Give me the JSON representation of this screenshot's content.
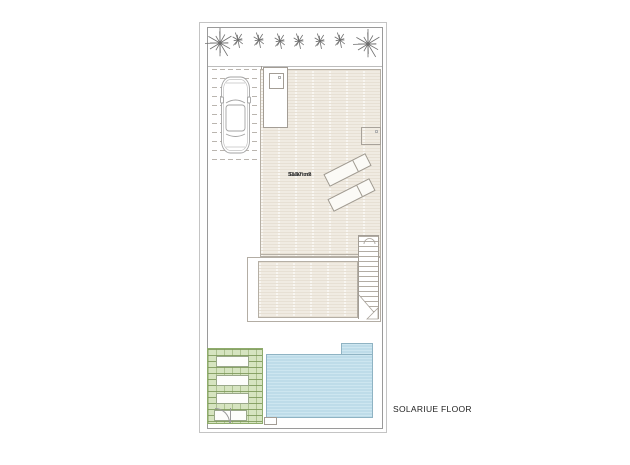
{
  "floor_label": "SOLARIUE FLOOR",
  "solarium": {
    "name": "Solarium",
    "area": "33.97 m2"
  },
  "colors": {
    "line": "#9a9a9a",
    "wall": "#a39d95",
    "deck-border": "#b5afa5",
    "deck-base": "#f0ebe2",
    "deck-stripe": "#e7e0d4",
    "pool-fill": "#bedce9",
    "pool-stripe": "#cde6f0",
    "pool-border": "#8fb3c3",
    "grass-fill": "#d6e4c0",
    "grass-line": "#8fac6c",
    "text": "#222222"
  },
  "trees": [
    {
      "kind": "palm-large",
      "x": 220,
      "y": 43
    },
    {
      "kind": "palm-small",
      "x": 238,
      "y": 40
    },
    {
      "kind": "palm-small",
      "x": 259,
      "y": 40
    },
    {
      "kind": "palm-small",
      "x": 280,
      "y": 41
    },
    {
      "kind": "palm-small",
      "x": 299,
      "y": 41
    },
    {
      "kind": "palm-small",
      "x": 320,
      "y": 41
    },
    {
      "kind": "palm-small",
      "x": 340,
      "y": 40
    },
    {
      "kind": "palm-large",
      "x": 368,
      "y": 44
    }
  ]
}
